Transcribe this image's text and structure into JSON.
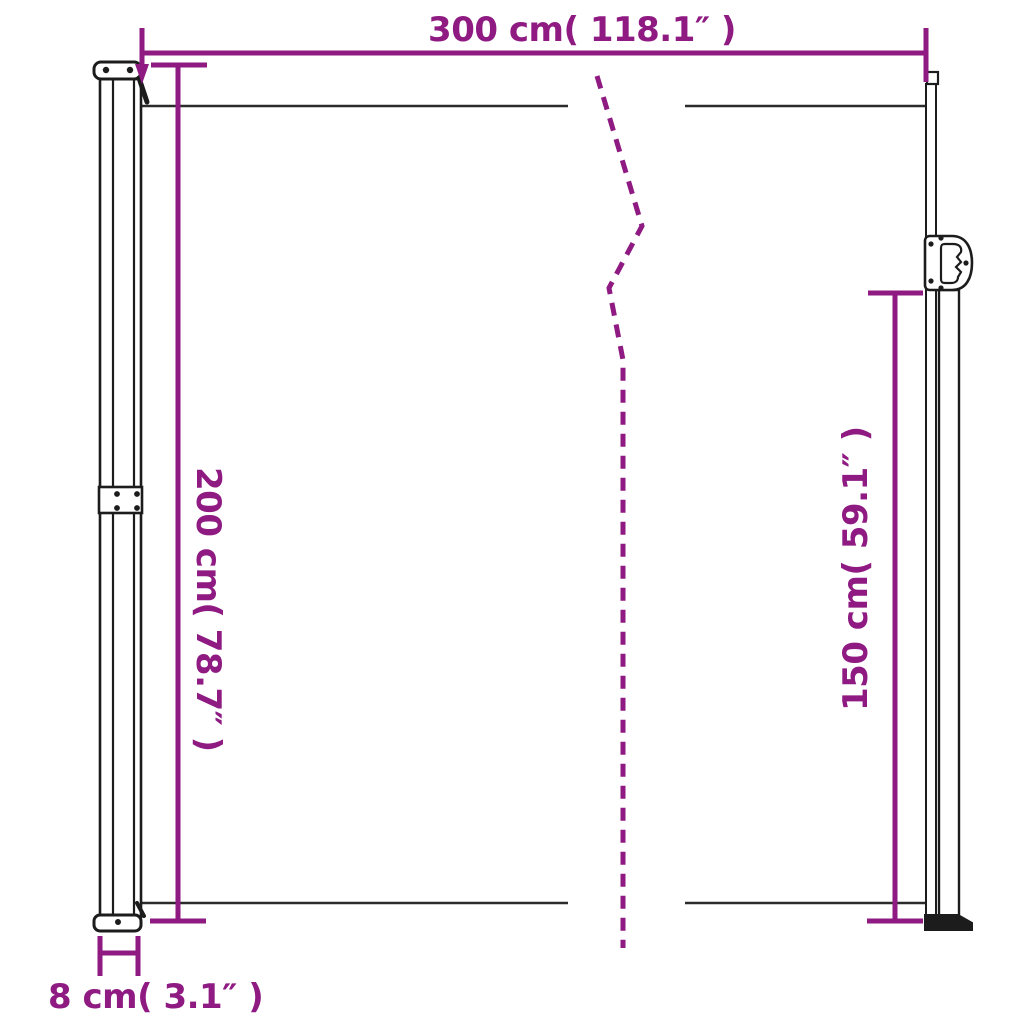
{
  "page": {
    "background": "#ffffff",
    "description": "Line-drawing dimension diagram of a retractable side awning with two posts and a screen, annotated with purple dimension lines"
  },
  "colors": {
    "dimension_accent": "#8e1a82",
    "drawing_outline": "#1c1c1c",
    "fabric_edge": "#2b2b2b"
  },
  "labels": {
    "width": "300 cm( 118.1″ )",
    "height_left": "200 cm( 78.7″ )",
    "height_right": "150 cm( 59.1″ )",
    "depth": "8 cm( 3.1″ )"
  },
  "dimensions": {
    "width": {
      "cm": 300,
      "inch": "118.1",
      "label": "300 cm( 118.1″ )",
      "position": "top, horizontal"
    },
    "height_left": {
      "cm": 200,
      "inch": "78.7",
      "label": "200 cm( 78.7″ )",
      "position": "left, vertical, reads downward"
    },
    "height_right": {
      "cm": 150,
      "inch": "59.1",
      "label": "150 cm( 59.1″ )",
      "position": "right, vertical, reads upward"
    },
    "depth": {
      "cm": 8,
      "inch": "3.1",
      "label": "8 cm( 3.1″ )",
      "position": "bottom-left, post depth"
    }
  }
}
